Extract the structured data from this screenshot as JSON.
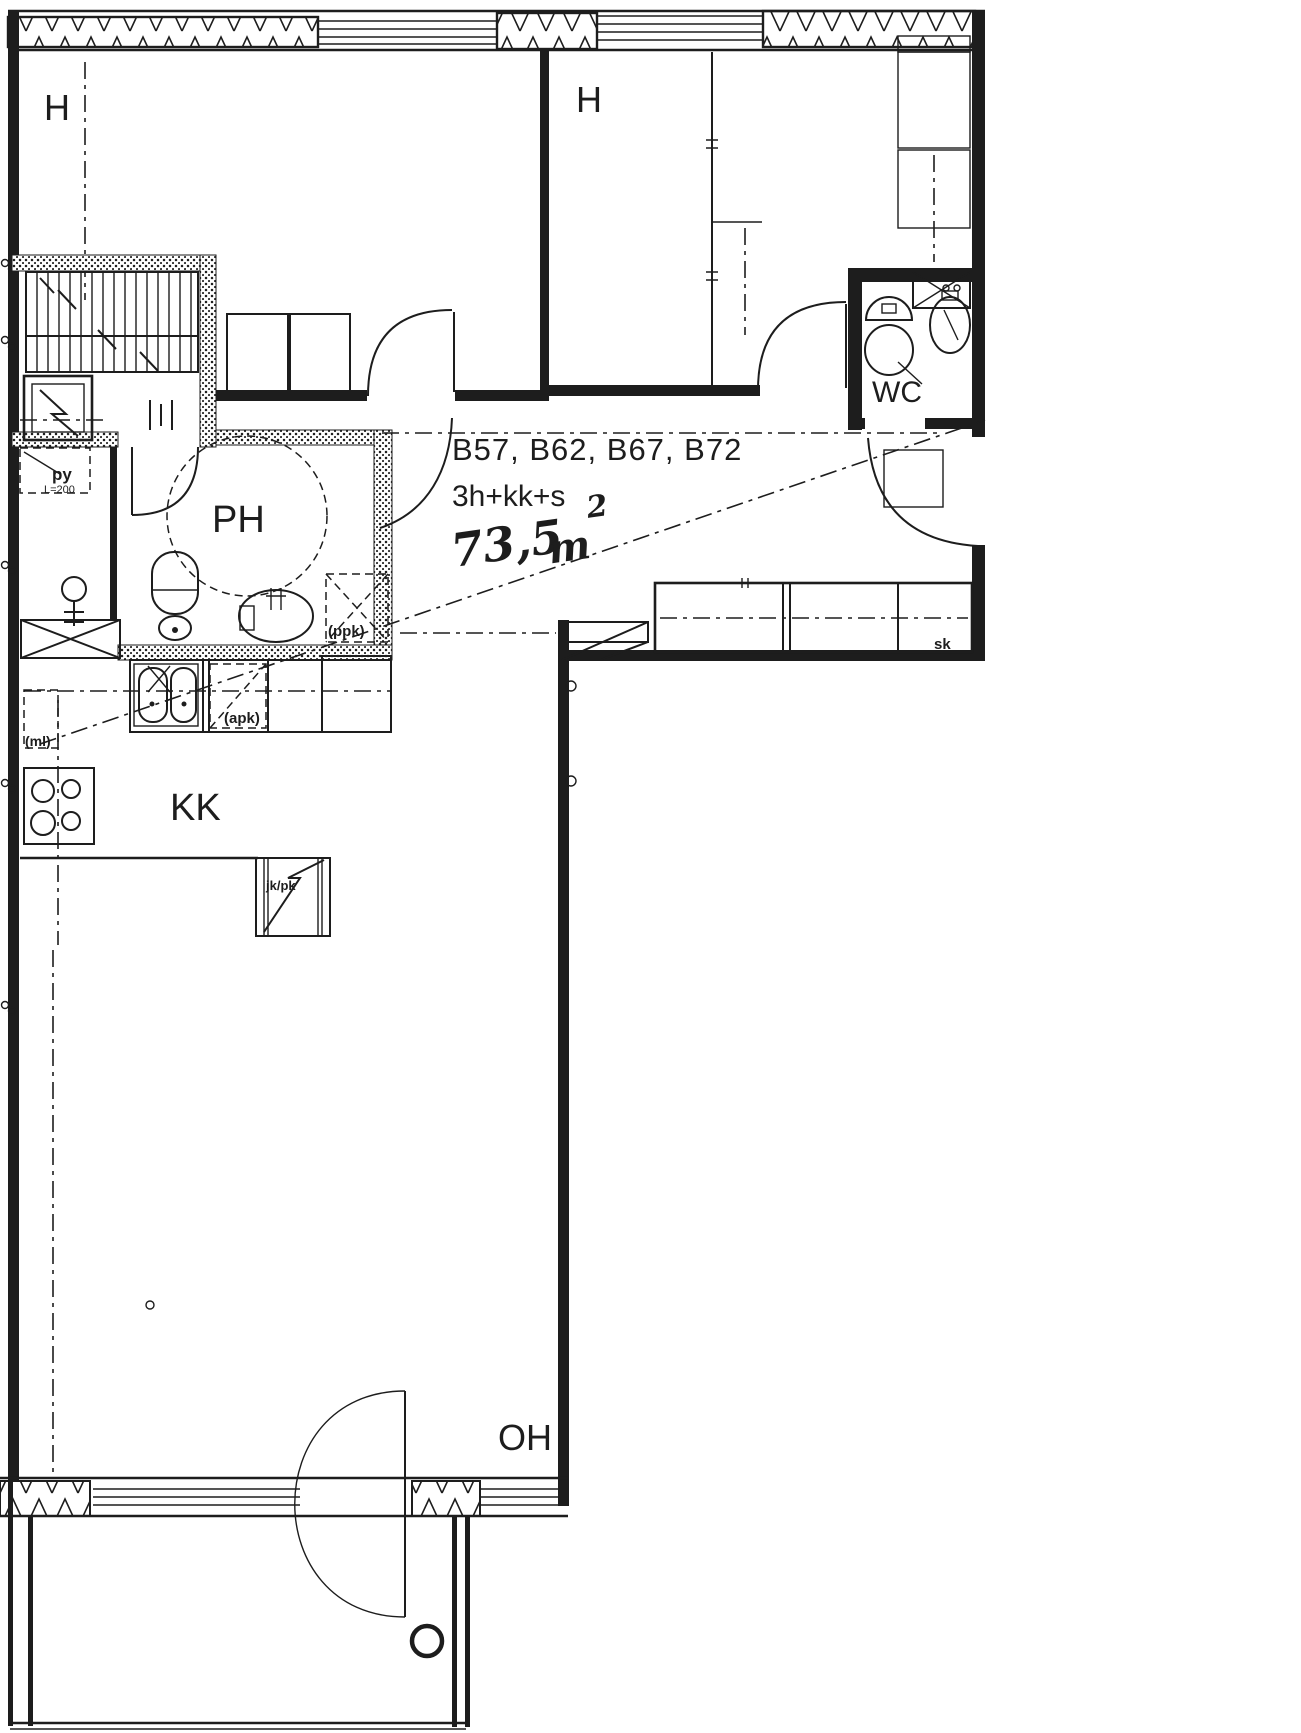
{
  "plan": {
    "title_ids": "B57, B62, B67, B72",
    "layout_code": "3h+kk+s",
    "area": {
      "value": "73,5",
      "unit": "m",
      "exponent": "2"
    },
    "rooms": {
      "bedroom_left": "H",
      "bedroom_right": "H",
      "bathroom": "PH",
      "toilet": "WC",
      "kitchenette": "KK",
      "living_room": "OH"
    },
    "fixtures": {
      "closet": "sk",
      "fridge_freezer": "jk/pk",
      "dishwasher_reservation": "(apk)",
      "washing_machine_reservation": "(ppk)",
      "microwave_reservation": "(ml)",
      "laundry_bin": "py",
      "laundry_bin_dim": "L=200"
    },
    "colors": {
      "ink": "#1d1d1d",
      "paper": "#ffffff"
    }
  }
}
